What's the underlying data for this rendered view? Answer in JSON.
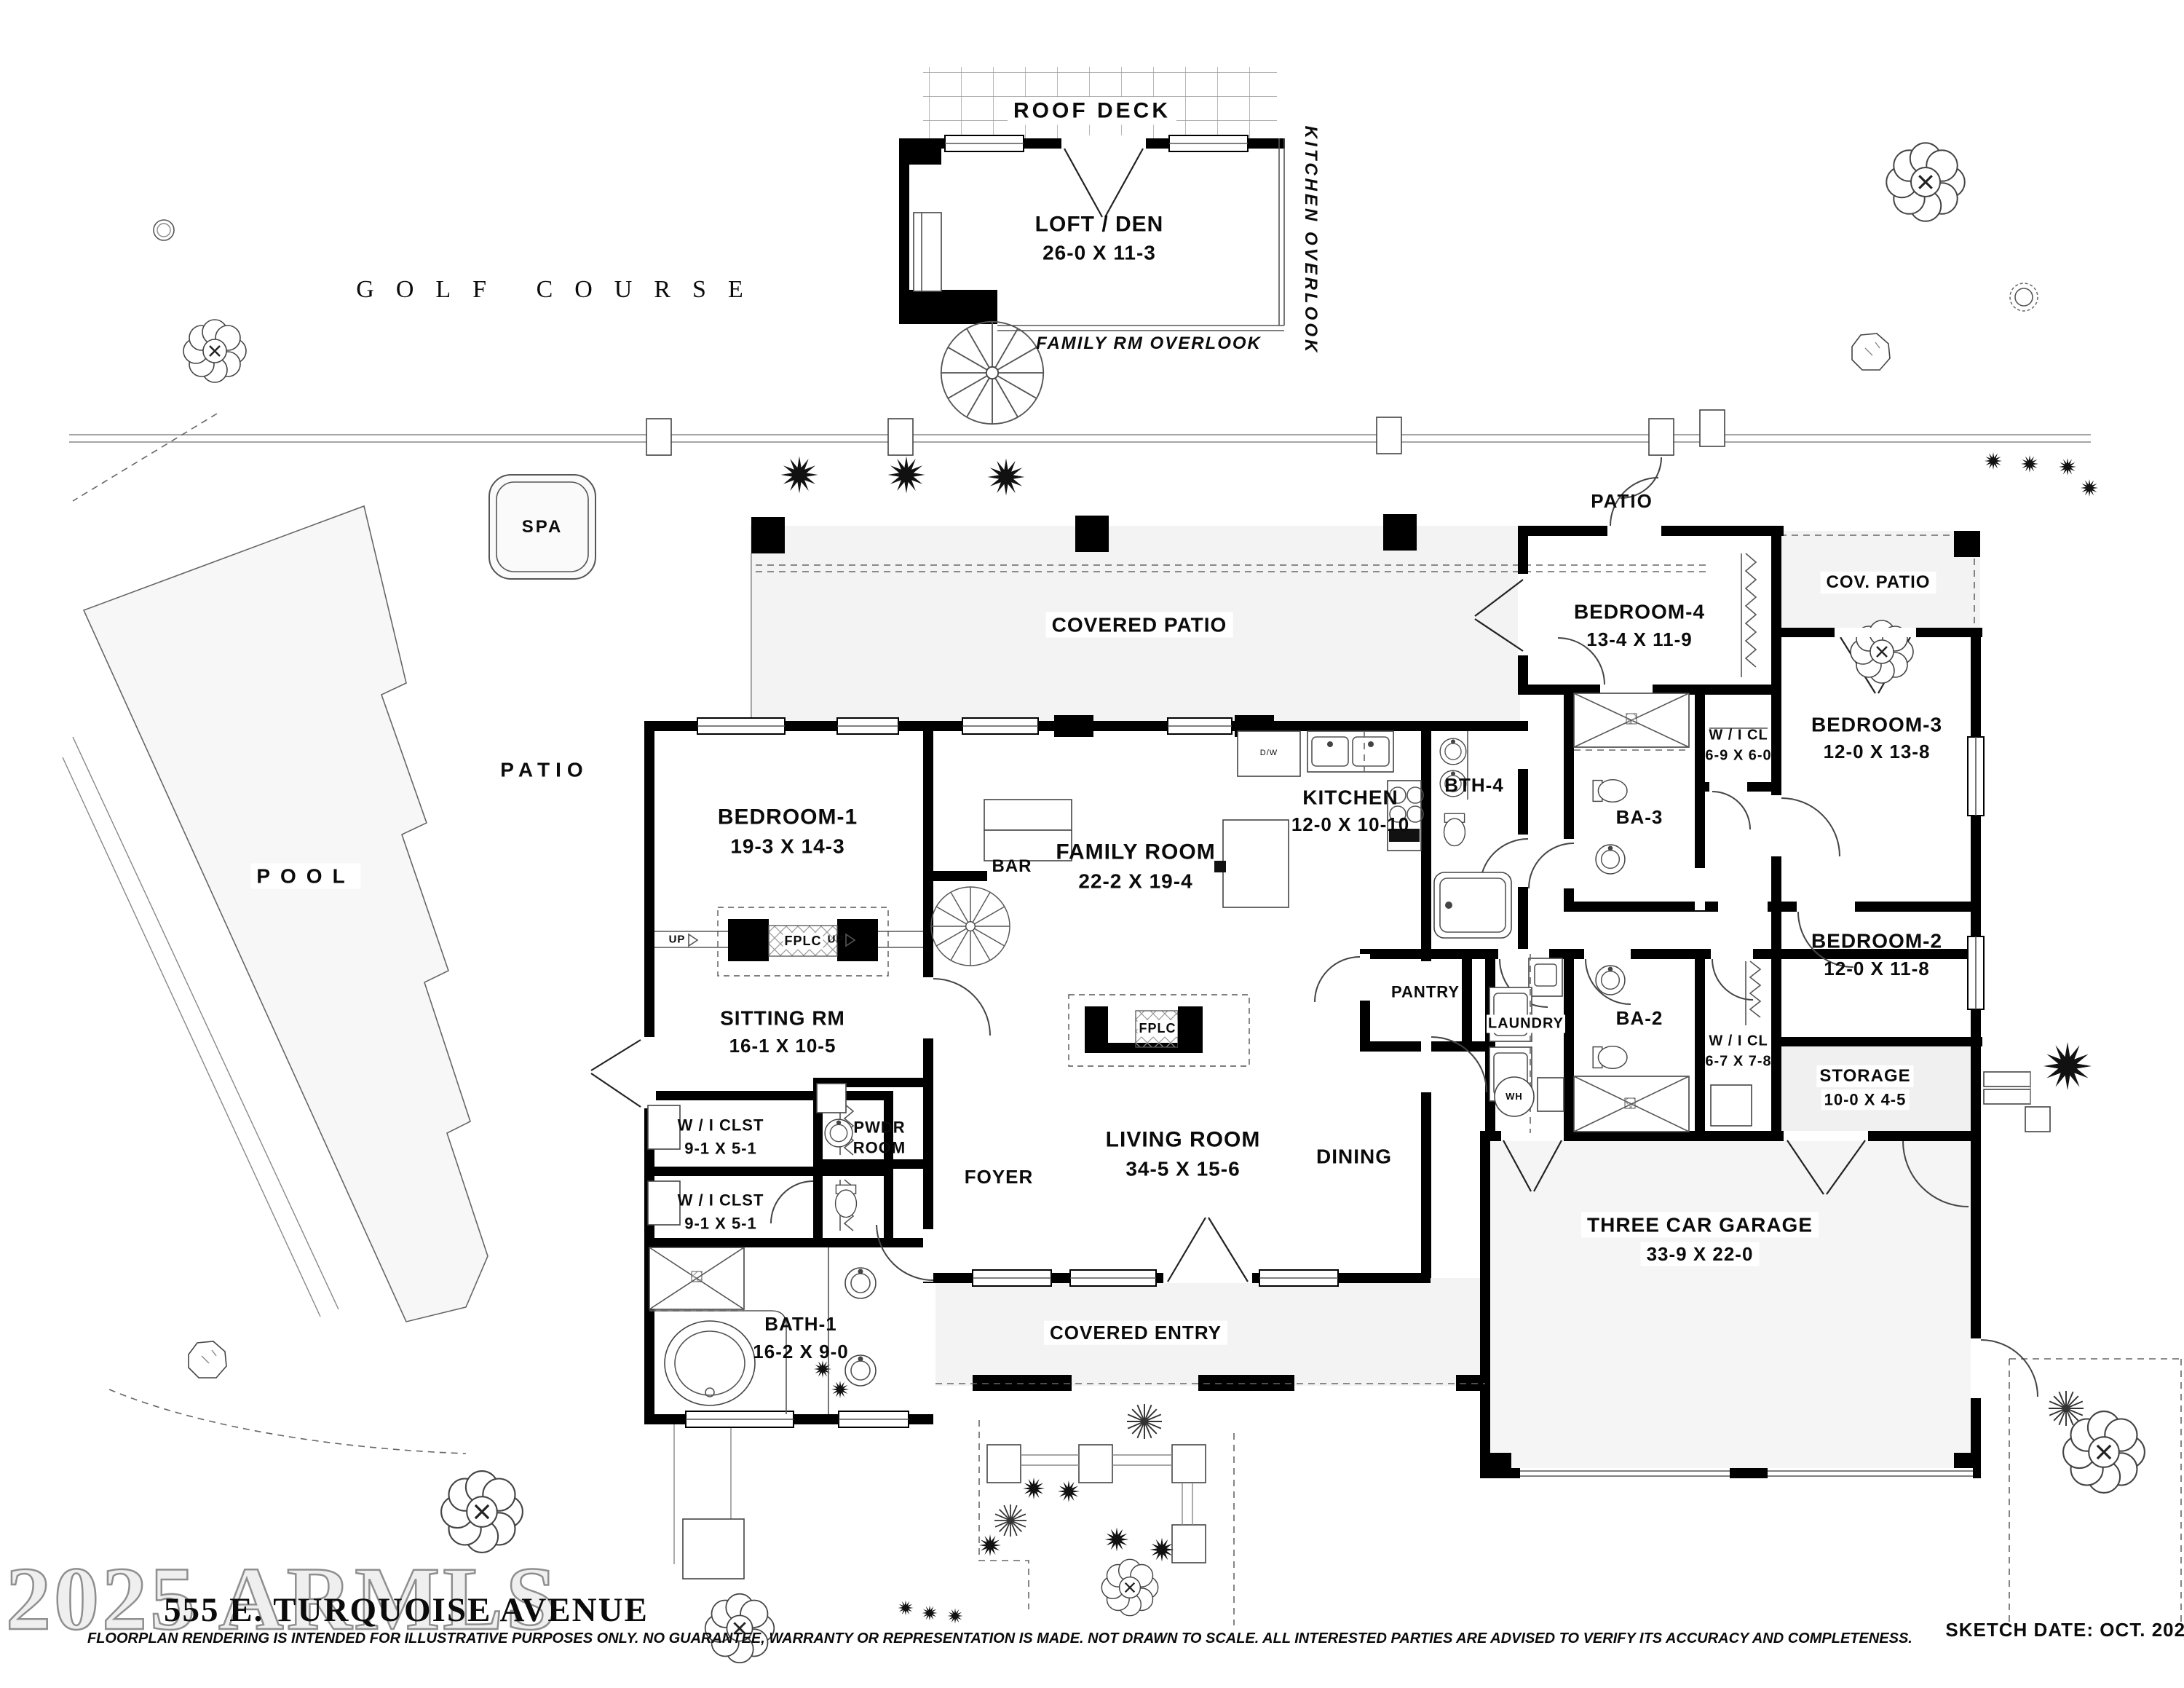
{
  "title_block": {
    "watermark": "2025 ARMLS",
    "address": "555 E. TURQUOISE AVENUE",
    "disclaimer": "FLOORPLAN RENDERING IS INTENDED FOR ILLUSTRATIVE PURPOSES ONLY.  NO GUARANTEE, WARRANTY OR REPRESENTATION IS MADE.  NOT DRAWN TO SCALE.  ALL INTERESTED PARTIES ARE ADVISED TO VERIFY ITS ACCURACY AND COMPLETENESS.",
    "sketch_date": "SKETCH DATE:  OCT. 2025"
  },
  "site": {
    "golf_course": "GOLF COURSE",
    "spa": "SPA",
    "pool": "POOL",
    "patio_west": "PATIO",
    "patio_north": "PATIO"
  },
  "upper_level": {
    "roof_deck": "ROOF  DECK",
    "loft_name": "LOFT / DEN",
    "loft_dims": "26-0 X 11-3",
    "kitchen_overlook": "KITCHEN OVERLOOK",
    "family_overlook": "FAMILY RM OVERLOOK"
  },
  "rooms": {
    "covered_patio": "COVERED PATIO",
    "cov_patio_2": "COV. PATIO",
    "covered_entry": "COVERED ENTRY",
    "bedroom1": {
      "name": "BEDROOM-1",
      "dims": "19-3  X  14-3"
    },
    "bedroom2": {
      "name": "BEDROOM-2",
      "dims": "12-0  X  11-8"
    },
    "bedroom3": {
      "name": "BEDROOM-3",
      "dims": "12-0  X  13-8"
    },
    "bedroom4": {
      "name": "BEDROOM-4",
      "dims": "13-4  X  11-9"
    },
    "sitting": {
      "name": "SITTING RM",
      "dims": "16-1  X  10-5"
    },
    "family": {
      "name": "FAMILY ROOM",
      "dims": "22-2  X  19-4"
    },
    "living": {
      "name": "LIVING ROOM",
      "dims": "34-5  X  15-6"
    },
    "dining": "DINING",
    "kitchen": {
      "name": "KITCHEN",
      "dims": "12-0 X 10-10"
    },
    "bath1": {
      "name": "BATH-1",
      "dims": "16-2 X 9-0"
    },
    "bth4": "BTH-4",
    "ba3": "BA-3",
    "ba2": "BA-2",
    "pwdr_1": "PWDR",
    "pwdr_2": "ROOM",
    "foyer": "FOYER",
    "pantry": "PANTRY",
    "bar": "BAR",
    "laundry": "LAUNDRY",
    "storage": {
      "name": "STORAGE",
      "dims": "10-0 X 4-5"
    },
    "garage": {
      "name": "THREE CAR GARAGE",
      "dims": "33-9  X  22-0"
    },
    "wi_clst": {
      "name": "W / I  CLST",
      "dims": "9-1  X  5-1"
    },
    "wicl_3": {
      "name": "W / I  CL",
      "dims": "6-9 X 6-0"
    },
    "wicl_2": {
      "name": "W / I  CL",
      "dims": "6-7 X 7-8"
    },
    "fplc": "FPLC",
    "up": "UP",
    "wh": "WH",
    "dw": "D/W"
  }
}
